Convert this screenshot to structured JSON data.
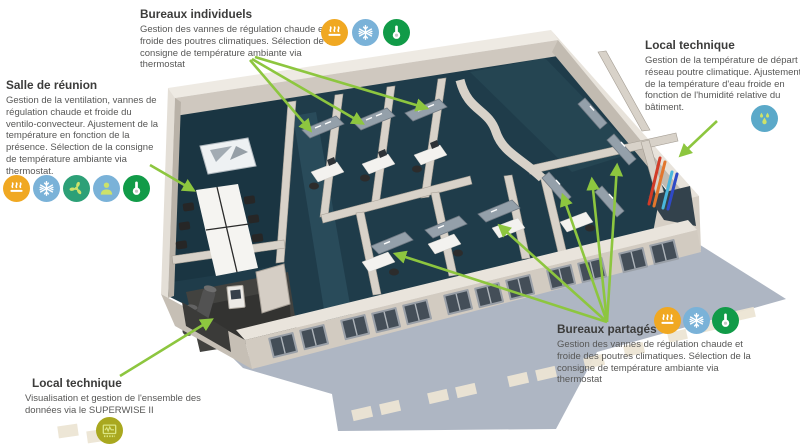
{
  "page": {
    "background": "#ffffff"
  },
  "colors": {
    "arrow_green": "#8dc63f",
    "title_text": "#3c3c3b",
    "body_text": "#575756",
    "carpet_teal": "#1f3c4a",
    "wall_beige": "#d8d2c9",
    "shadow_gray": "#9aa4b4"
  },
  "icon_defs": {
    "heating": {
      "glyph": "heat-waves",
      "bg": "#f0a822",
      "fg": "#ffffff"
    },
    "cooling": {
      "glyph": "snowflake",
      "bg": "#7ab2d8",
      "fg": "#ffffff"
    },
    "ventilation": {
      "glyph": "fan",
      "bg": "#2da077",
      "fg": "#cde26a"
    },
    "presence": {
      "glyph": "person",
      "bg": "#7ab2d8",
      "fg": "#cde26a"
    },
    "temperature": {
      "glyph": "thermometer",
      "bg": "#119b48",
      "fg": "#ffffff"
    },
    "humidity": {
      "glyph": "water-drops",
      "bg": "#5ba9c9",
      "fg": "#cde26a"
    },
    "supervision": {
      "glyph": "monitor-graph",
      "bg": "#a9a81f",
      "fg": "#dbe683"
    }
  },
  "annotations": {
    "bureaux_individuels": {
      "title": "Bureaux individuels",
      "body": "Gestion des vannes de régulation chaude et froide des poutres climatiques. Sélection de la consigne de température ambiante via thermostat",
      "icons": [
        "heating",
        "cooling",
        "temperature"
      ]
    },
    "salle_de_reunion": {
      "title": "Salle de réunion",
      "body": "Gestion de la ventilation, vannes de régulation chaude et froide du ventilo-convecteur. Ajustement de la température en fonction de la présence. Sélection de la consigne de température ambiante via thermostat.",
      "icons": [
        "heating",
        "cooling",
        "ventilation",
        "presence",
        "temperature"
      ]
    },
    "local_technique_droit": {
      "title": "Local technique",
      "body": "Gestion de la température de départ du réseau poutre climatique. Ajustement de la température d'eau froide en fonction de l'humidité relative du bâtiment.",
      "icons": [
        "humidity"
      ]
    },
    "bureaux_partages": {
      "title": "Bureaux partagés",
      "body": "Gestion des vannes de régulation chaude et froide des poutres climatiques. Sélection de la consigne de température ambiante via thermostat",
      "icons": [
        "heating",
        "cooling",
        "temperature"
      ]
    },
    "local_technique_gauche": {
      "title": "Local technique",
      "body": "Visualisation et gestion de l'ensemble des données via le SUPERWISE II",
      "icons": [
        "supervision"
      ]
    }
  }
}
